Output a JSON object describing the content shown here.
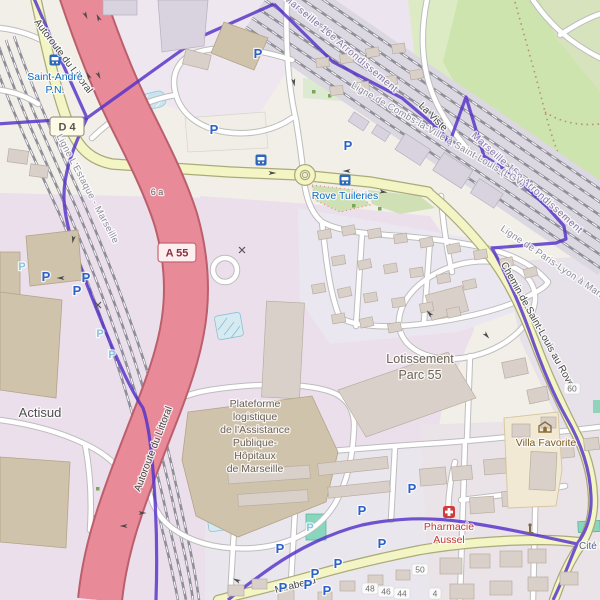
{
  "map": {
    "labels": {
      "motorway_name": "Autoroute du Littoral",
      "motorway_ref": "A 55",
      "junction_ref": "6 a",
      "road_d4_ref": "D 4",
      "boundary_16e": "Marseille 16e Arrondissement",
      "boundary_15e": "Marseille 15e Arrondissement",
      "railway_lgv": "Ligne de Combs-la-Ville à Saint-Louis (LGV)",
      "railway_plm": "Ligne de Paris-Lyon à Marseille-Saint-Charles",
      "railway_estaque": "Ligne L'Estaque - Marseille",
      "road_chemin": "Chemin de Saint-Louis au Rove",
      "road_mirabeau": "Mirabeau",
      "road_la_viste": "La Viste",
      "place_actisud": "Actisud",
      "lotissement": [
        "Lotissement",
        "Parc 55"
      ],
      "plateforme": [
        "Plateforme",
        "logistique",
        "de l'Assistance",
        "Publique-",
        "Hôpitaux",
        "de Marseille"
      ],
      "villa_favorite": "Villa Favorite",
      "pharmacie": [
        "Pharmacie",
        "Aussel"
      ],
      "cite": "Cité S",
      "bus_saint_andre": [
        "Saint-André",
        "P.N."
      ],
      "bus_rove_tuileries": "Rove Tuileries",
      "parking_symbol": "P"
    },
    "house_numbers": [
      "50",
      "60",
      "48",
      "46",
      "44",
      "4"
    ],
    "colors": {
      "motorway": "#e98a99",
      "secondary_road": "#f4f5c5",
      "boundary_purple": "#5431c9",
      "park_green": "#cde4ae",
      "industrial_lavender": "#ecdfec",
      "building": "#d9d0c9",
      "water_basin": "#c9e4f0",
      "bus_blue": "#0f6ac2",
      "parking_blue": "#2a62c9",
      "pharmacy_red": "#d23b3b",
      "historic_brown": "#8a6d3b"
    }
  }
}
